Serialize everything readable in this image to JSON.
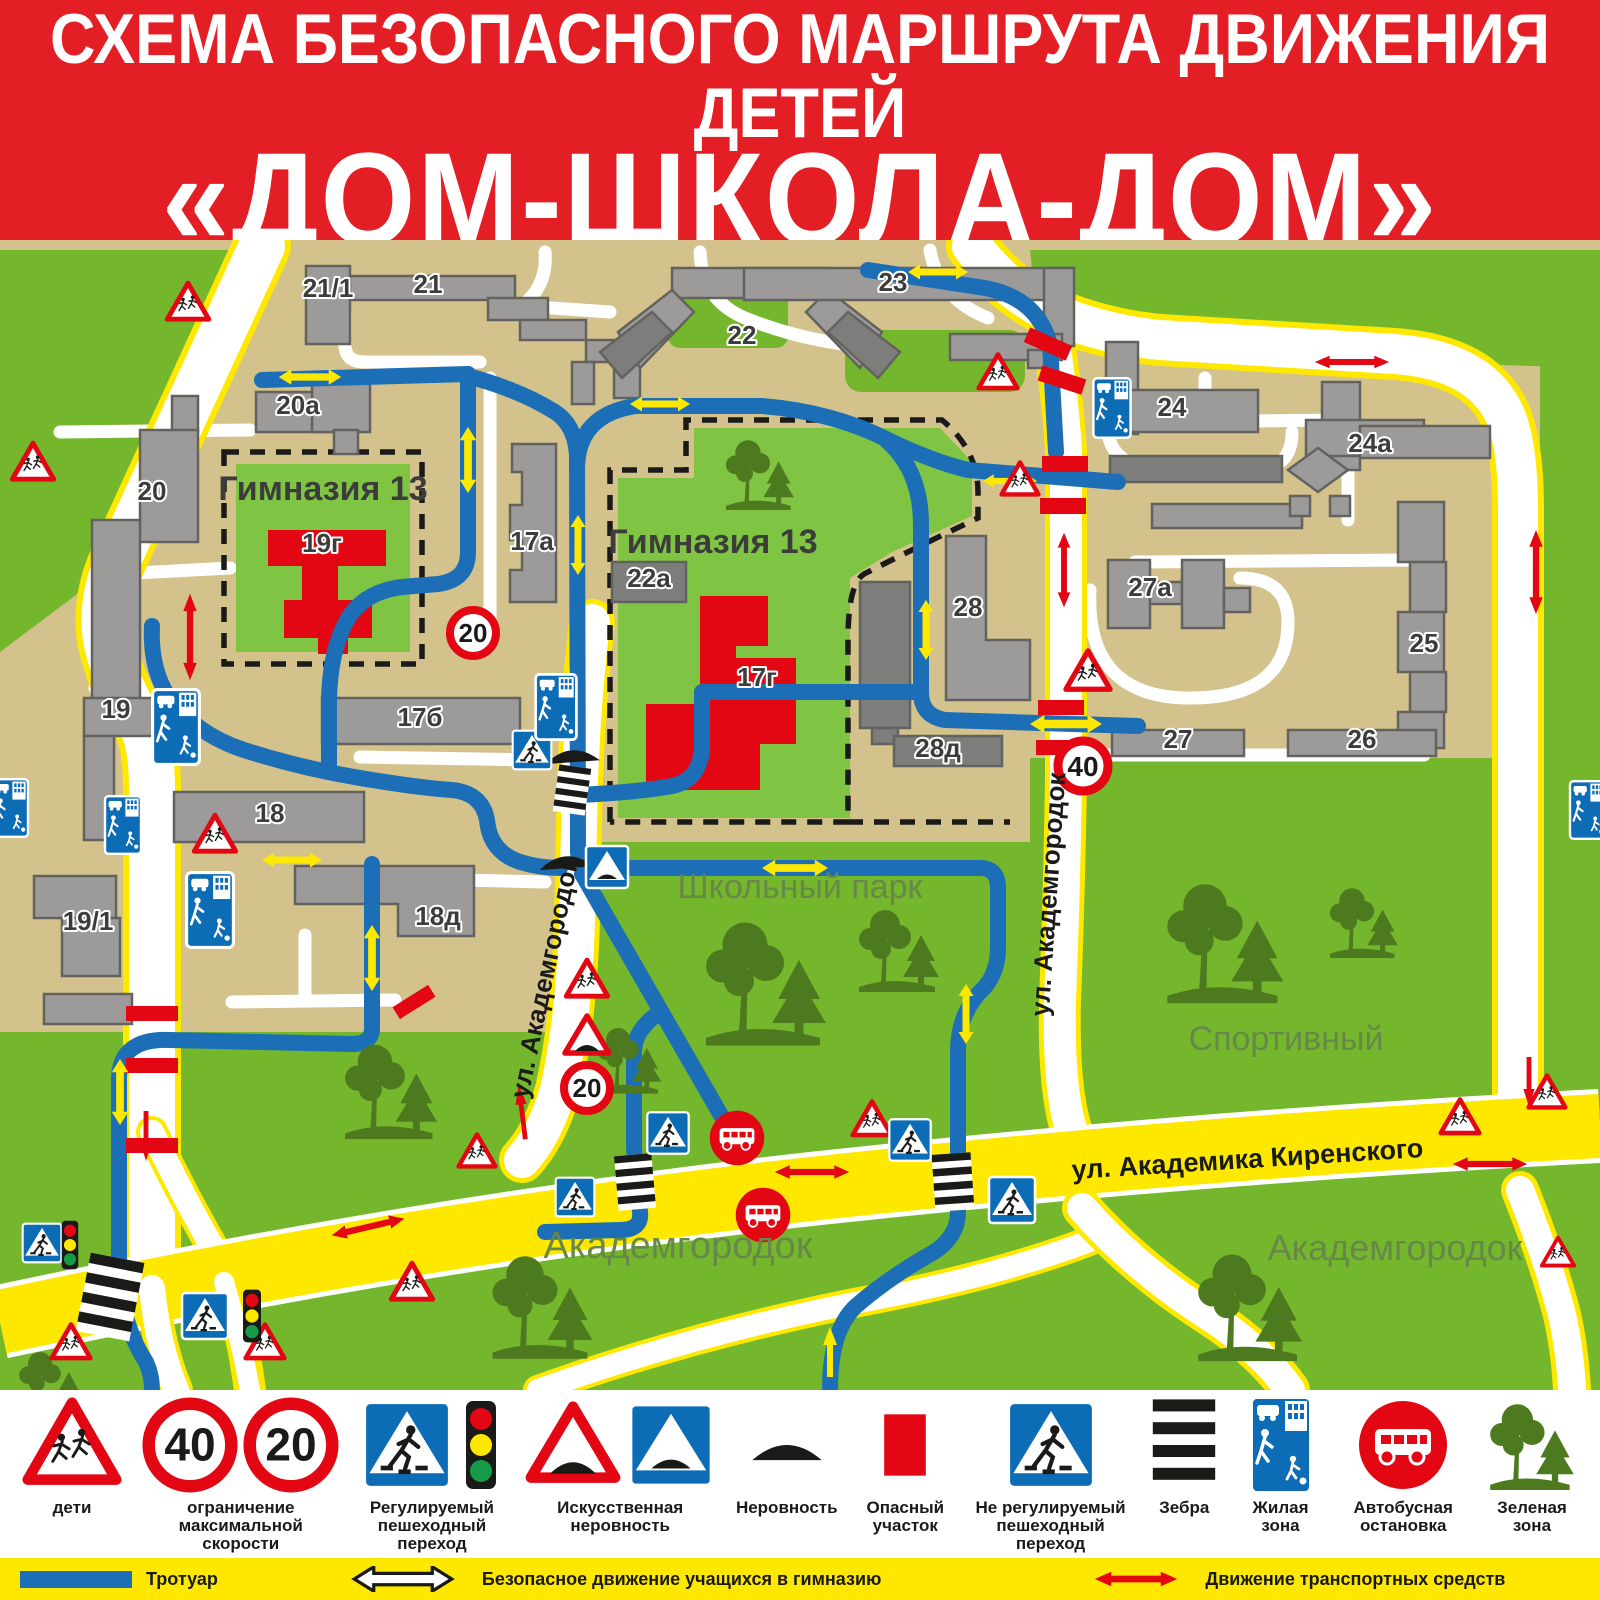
{
  "title": {
    "line1": "СХЕМА БЕЗОПАСНОГО МАРШРУТА ДВИЖЕНИЯ ДЕТЕЙ",
    "line2": "«ДОМ-ШКОЛА-ДОМ»",
    "line3": "МАОУ «Гимназия №13 Академ»"
  },
  "map": {
    "school_labels": [
      {
        "label": "Гимназия 13"
      },
      {
        "label": "Гимназия 13"
      }
    ],
    "buildings": [
      {
        "label": "21/1"
      },
      {
        "label": "21"
      },
      {
        "label": "20а"
      },
      {
        "label": "20"
      },
      {
        "label": "19"
      },
      {
        "label": "19/1"
      },
      {
        "label": "17а"
      },
      {
        "label": "17б"
      },
      {
        "label": "18"
      },
      {
        "label": "18д"
      },
      {
        "label": "19г"
      },
      {
        "label": "22а"
      },
      {
        "label": "17г"
      },
      {
        "label": "22"
      },
      {
        "label": "23"
      },
      {
        "label": "24"
      },
      {
        "label": "24а"
      },
      {
        "label": "27а"
      },
      {
        "label": "25"
      },
      {
        "label": "28"
      },
      {
        "label": "28д"
      },
      {
        "label": "27"
      },
      {
        "label": "26"
      }
    ],
    "streets": [
      {
        "label": "ул. Академгородок"
      },
      {
        "label": "ул. Академгородок"
      },
      {
        "label": "ул. Академика Киренского"
      }
    ],
    "areas": [
      {
        "label": "Школьный парк"
      },
      {
        "label": "Спортивный"
      },
      {
        "label": "Академгородок"
      },
      {
        "label": "Академгородок"
      }
    ],
    "speed_signs": [
      {
        "value": "20"
      },
      {
        "value": "40"
      },
      {
        "value": "20"
      }
    ],
    "symbols": {
      "children-sign-icon": "red warning triangle with running children",
      "crosswalk-sign-icon": "blue square pedestrian crossing sign",
      "traffic-light-icon": "traffic light red/yellow/green",
      "speed-bump-warning-icon": "red triangle with bump",
      "speed-bump-sign-icon": "blue square with bump",
      "road-bump-icon": "black speed bump",
      "danger-zone-icon": "red rectangle",
      "zebra-icon": "zebra crossing stripes",
      "residential-zone-icon": "blue residential zone sign",
      "bus-stop-icon": "red circle with white bus",
      "green-zone-icon": "green trees"
    }
  },
  "legend": {
    "speed40": "40",
    "speed20": "20",
    "items": [
      {
        "label": "дети"
      },
      {
        "label": "ограничение максимальной скорости"
      },
      {
        "label": "Регулируемый пешеходный переход"
      },
      {
        "label": "Искусственная неровность"
      },
      {
        "label": "Неровность"
      },
      {
        "label": "Опасный участок"
      },
      {
        "label": "Не регулируемый пешеходный переход"
      },
      {
        "label": "Зебра"
      },
      {
        "label": "Жилая зона"
      },
      {
        "label": "Автобусная остановка"
      },
      {
        "label": "Зеленая зона"
      }
    ],
    "strip": [
      {
        "label": "Тротуар"
      },
      {
        "label": "Безопасное движение учащихся в гимназию"
      },
      {
        "label": "Движение транспортных средств"
      },
      {
        "label": "Ограждение"
      }
    ]
  },
  "colors": {
    "banner_red": "#E31E24",
    "route_blue": "#1C6FB6",
    "safe_arrow_yellow": "#FFE800",
    "transport_arrow_red": "#E30613",
    "road_yellow": "#FFE800",
    "base_green": "#74B72C",
    "school_green": "#7FC443",
    "ground_tan": "#D3C28B",
    "building_gray": "#9C9B9A"
  }
}
